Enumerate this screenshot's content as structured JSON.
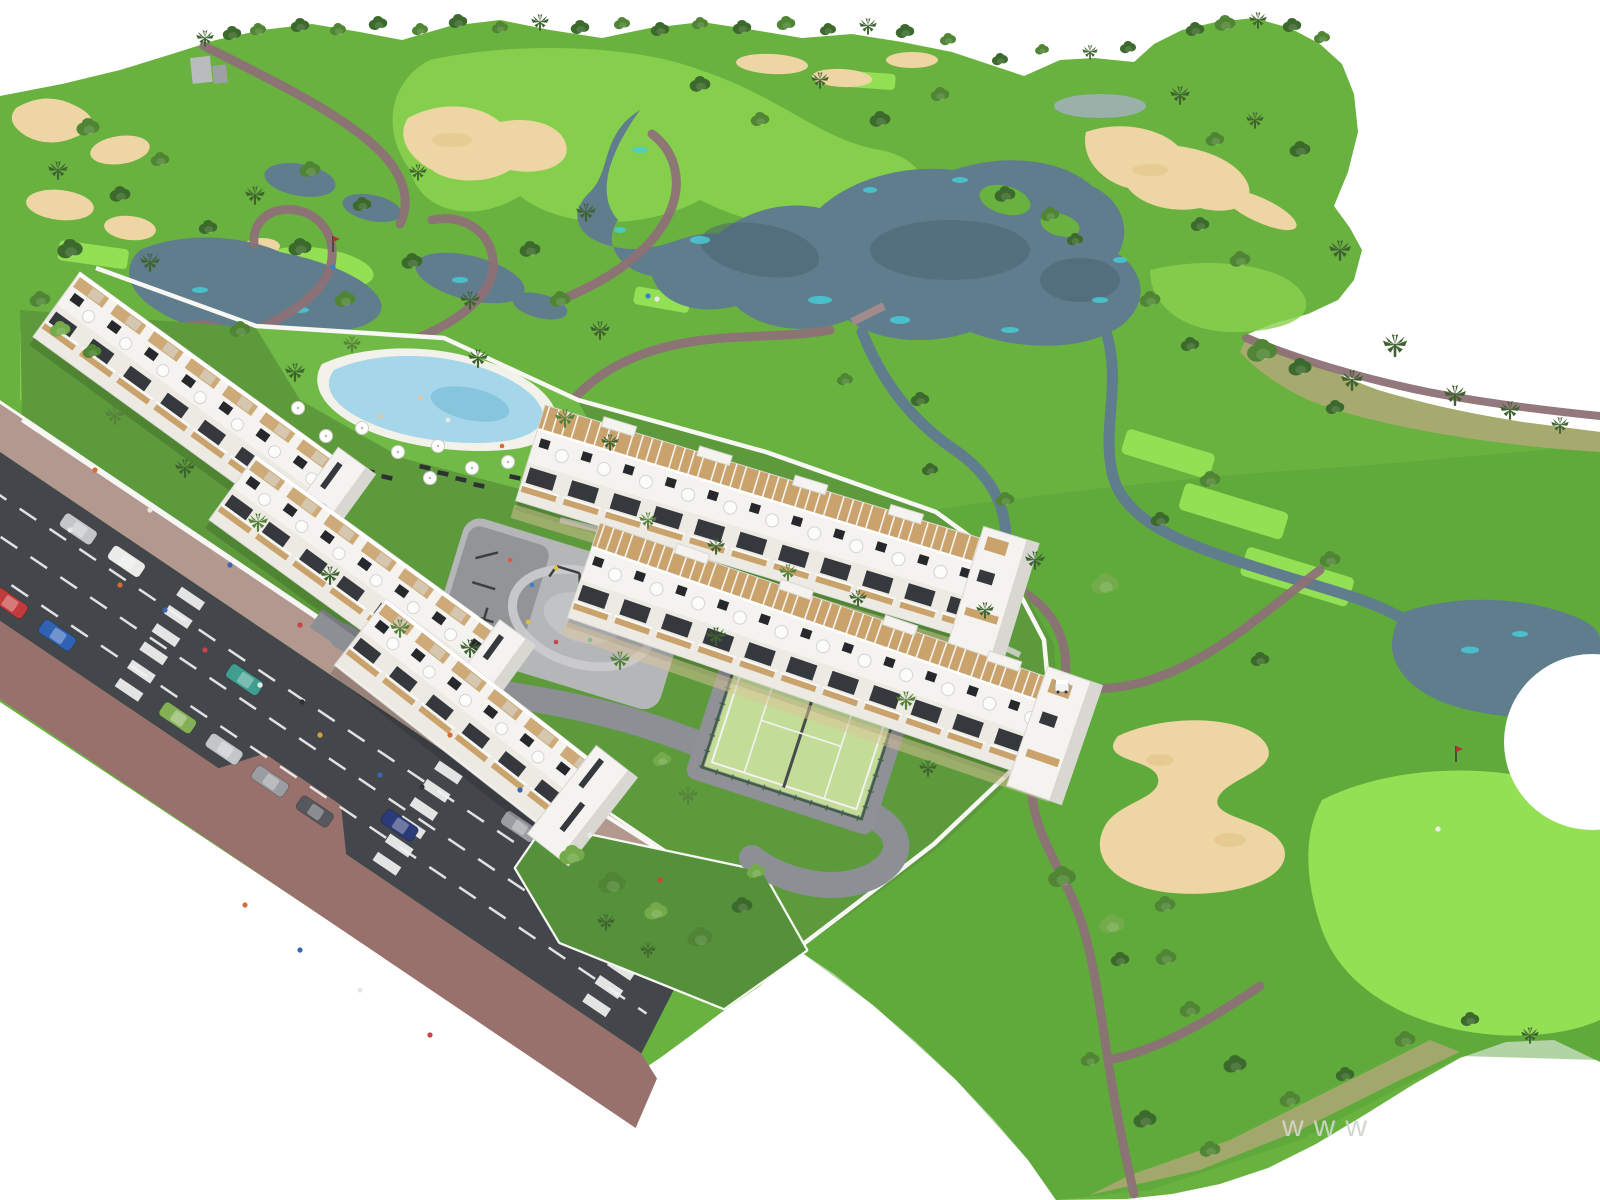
{
  "scene": {
    "type": "aerial-3d-architectural-render",
    "subject": "white apartment resort beside golf course with lakes, bunkers, pool, padel court and access road",
    "watermark": "www"
  },
  "palette": {
    "bg": "#ffffff",
    "grass": "#69b23f",
    "grass_light": "#8ad14f",
    "grass_bright": "#93e055",
    "grass_dark": "#55a038",
    "lawn": "#72ba47",
    "garden": "#5d9a3c",
    "garden_dark": "#55903a",
    "scrub": "#b3a878",
    "sand": "#edd6a3",
    "sand_dark": "#dfc083",
    "water": "#5f7d8d",
    "water_dark": "#49626f",
    "water_teal": "#45d0da",
    "pond_gray": "#9fb0b4",
    "pool": "#a5d6e9",
    "pool_deep": "#7fc0da",
    "path": "#8d7176",
    "path_light": "#a18a8c",
    "road": "#43474c",
    "sidewalk": "#99716c",
    "sidewalk_light": "#b3988f",
    "line_white": "#f2f2f2",
    "wall": "#f7f7f4",
    "bldg": "#f4f3ef",
    "bldg_shadow": "#d8d7d2",
    "facade": "#eceae3",
    "window": "#35383c",
    "wood": "#c9a26c",
    "plaza": "#b5b6b8",
    "plaza_dark": "#8c8e92",
    "court": "#c3dc97",
    "fence": "#415f48",
    "tree_dark": "#3c6a2c",
    "tree_mid": "#4f8534",
    "tree_light": "#74ab4a",
    "palm": "#3f6330",
    "palm_light": "#55823a",
    "watermark": "#cfd5cb"
  },
  "road": {
    "cars": [
      [
        108,
        20,
        "#c3c6c9"
      ],
      [
        166,
        20,
        "#ebebe9"
      ],
      [
        640,
        20,
        "#9a9da1"
      ],
      [
        700,
        21,
        "#55585c"
      ],
      [
        758,
        22,
        "#c3c6c9"
      ],
      [
        34,
        120,
        "#ebebe9"
      ],
      [
        92,
        120,
        "#c23a3a"
      ],
      [
        150,
        120,
        "#2f62b4"
      ],
      [
        296,
        121,
        "#83b054"
      ],
      [
        352,
        121,
        "#c3c6c9"
      ],
      [
        408,
        122,
        "#9a9da1"
      ],
      [
        462,
        122,
        "#55585c"
      ],
      [
        540,
        86,
        "#2b3a78"
      ],
      [
        330,
        52,
        "#3f9e8f"
      ],
      [
        845,
        60,
        "#55585c"
      ]
    ]
  },
  "people": [
    [
      70,
      530,
      "#e8e8e8"
    ],
    [
      120,
      585,
      "#d96a35"
    ],
    [
      165,
      610,
      "#3a66b0"
    ],
    [
      205,
      650,
      "#c94444"
    ],
    [
      260,
      685,
      "#e8e8e8"
    ],
    [
      320,
      735,
      "#d9a13a"
    ],
    [
      380,
      775,
      "#3a66b0"
    ],
    [
      95,
      470,
      "#d96a35"
    ],
    [
      150,
      510,
      "#e8e8e8"
    ],
    [
      230,
      565,
      "#3a66b0"
    ],
    [
      300,
      625,
      "#c94444"
    ],
    [
      375,
      680,
      "#e8e8e8"
    ],
    [
      450,
      735,
      "#d96a35"
    ],
    [
      520,
      790,
      "#3a66b0"
    ],
    [
      590,
      835,
      "#e8e8e8"
    ],
    [
      660,
      880,
      "#c94444"
    ],
    [
      245,
      905,
      "#d96a35"
    ],
    [
      300,
      950,
      "#3a66b0"
    ],
    [
      360,
      990,
      "#e8e8e8"
    ],
    [
      430,
      1035,
      "#c94444"
    ],
    [
      302,
      702,
      "#2f3234"
    ],
    [
      422,
      787,
      "#2f3234"
    ]
  ],
  "pool": {
    "umbrellas": [
      [
        298,
        408
      ],
      [
        326,
        436
      ],
      [
        362,
        428
      ],
      [
        398,
        452
      ],
      [
        438,
        446
      ],
      [
        472,
        468
      ],
      [
        508,
        462
      ],
      [
        546,
        452
      ],
      [
        584,
        444
      ],
      [
        350,
        468
      ],
      [
        312,
        452
      ],
      [
        430,
        478
      ],
      [
        282,
        430
      ],
      [
        596,
        462
      ]
    ],
    "swimmers": [
      [
        380,
        416,
        "#e8c49e"
      ],
      [
        448,
        420,
        "#e8e8e8"
      ],
      [
        502,
        446,
        "#d96a35"
      ],
      [
        420,
        398,
        "#e8c49e"
      ]
    ]
  },
  "playground": {
    "people": [
      [
        510,
        560,
        "#d95f3b"
      ],
      [
        532,
        585,
        "#3a7fd0"
      ],
      [
        556,
        568,
        "#e0c23a"
      ],
      [
        576,
        600,
        "#c94444"
      ],
      [
        598,
        586,
        "#3fae9e"
      ],
      [
        618,
        612,
        "#e8e8e8"
      ],
      [
        640,
        600,
        "#d95f3b"
      ],
      [
        662,
        626,
        "#3a7fd0"
      ],
      [
        528,
        622,
        "#e0c23a"
      ],
      [
        556,
        642,
        "#c94444"
      ],
      [
        590,
        640,
        "#3fae9e"
      ],
      [
        622,
        560,
        "#e8e8e8"
      ]
    ]
  },
  "golf": {
    "figures": [
      [
        648,
        296,
        "#3a7fd0"
      ],
      [
        657,
        299,
        "#e8e8e8"
      ],
      [
        333,
        267,
        "#3a7fd0"
      ],
      [
        1438,
        829,
        "#ececec"
      ]
    ],
    "flags": [
      [
        333,
        252
      ],
      [
        1456,
        762
      ]
    ],
    "cart": [
      1062,
      688
    ]
  },
  "vegetation": [
    [
      205,
      38,
      "p",
      0.8,
      "palm"
    ],
    [
      232,
      34,
      "d",
      0.8,
      "tree_dark"
    ],
    [
      258,
      30,
      "d",
      0.7,
      "tree_mid"
    ],
    [
      300,
      26,
      "d",
      0.8,
      "tree_dark"
    ],
    [
      338,
      30,
      "d",
      0.7,
      "tree_mid"
    ],
    [
      378,
      24,
      "d",
      0.8,
      "tree_dark"
    ],
    [
      420,
      30,
      "d",
      0.7,
      "tree_mid"
    ],
    [
      458,
      22,
      "d",
      0.8,
      "tree_dark"
    ],
    [
      500,
      28,
      "d",
      0.7,
      "tree_mid"
    ],
    [
      540,
      22,
      "p",
      0.8,
      "palm"
    ],
    [
      580,
      28,
      "d",
      0.8,
      "tree_dark"
    ],
    [
      622,
      24,
      "d",
      0.7,
      "tree_mid"
    ],
    [
      660,
      30,
      "d",
      0.8,
      "tree_dark"
    ],
    [
      700,
      24,
      "d",
      0.7,
      "tree_mid"
    ],
    [
      742,
      28,
      "d",
      0.8,
      "tree_dark"
    ],
    [
      786,
      24,
      "d",
      0.8,
      "tree_mid"
    ],
    [
      828,
      30,
      "d",
      0.7,
      "tree_dark"
    ],
    [
      868,
      26,
      "p",
      0.8,
      "palm"
    ],
    [
      905,
      32,
      "d",
      0.8,
      "tree_dark"
    ],
    [
      948,
      40,
      "d",
      0.7,
      "tree_mid"
    ],
    [
      1000,
      60,
      "d",
      0.7,
      "tree_dark"
    ],
    [
      1042,
      50,
      "d",
      0.6,
      "tree_mid"
    ],
    [
      1090,
      52,
      "p",
      0.7,
      "palm"
    ],
    [
      1128,
      48,
      "d",
      0.7,
      "tree_dark"
    ],
    [
      1195,
      30,
      "d",
      0.8,
      "tree_dark"
    ],
    [
      1225,
      24,
      "d",
      0.9,
      "tree_mid"
    ],
    [
      1258,
      20,
      "p",
      0.8,
      "palm"
    ],
    [
      1292,
      26,
      "d",
      0.8,
      "tree_dark"
    ],
    [
      1322,
      38,
      "d",
      0.7,
      "tree_mid"
    ],
    [
      88,
      128,
      "d",
      1,
      "tree_mid"
    ],
    [
      58,
      170,
      "p",
      0.9,
      "palm"
    ],
    [
      120,
      195,
      "d",
      0.9,
      "tree_dark"
    ],
    [
      160,
      160,
      "d",
      0.8,
      "tree_mid"
    ],
    [
      70,
      250,
      "d",
      1.1,
      "tree_dark"
    ],
    [
      150,
      262,
      "p",
      0.9,
      "palm"
    ],
    [
      40,
      300,
      "d",
      0.9,
      "tree_mid"
    ],
    [
      208,
      228,
      "d",
      0.8,
      "tree_dark"
    ],
    [
      255,
      195,
      "p",
      0.9,
      "palm"
    ],
    [
      310,
      170,
      "d",
      0.9,
      "tree_mid"
    ],
    [
      362,
      205,
      "d",
      0.8,
      "tree_dark"
    ],
    [
      418,
      172,
      "p",
      0.8,
      "palm"
    ],
    [
      300,
      248,
      "d",
      1,
      "tree_dark"
    ],
    [
      345,
      300,
      "d",
      0.9,
      "tree_mid"
    ],
    [
      412,
      262,
      "d",
      0.9,
      "tree_dark"
    ],
    [
      470,
      300,
      "p",
      0.9,
      "palm"
    ],
    [
      240,
      330,
      "d",
      0.9,
      "tree_mid"
    ],
    [
      60,
      330,
      "d",
      0.9,
      "tree_light"
    ],
    [
      92,
      352,
      "d",
      0.8,
      "tree_mid"
    ],
    [
      530,
      250,
      "d",
      0.9,
      "tree_dark"
    ],
    [
      586,
      212,
      "p",
      0.9,
      "palm"
    ],
    [
      560,
      300,
      "d",
      0.9,
      "tree_mid"
    ],
    [
      600,
      330,
      "p",
      0.9,
      "palm"
    ],
    [
      700,
      85,
      "d",
      0.9,
      "tree_dark"
    ],
    [
      760,
      120,
      "d",
      0.8,
      "tree_mid"
    ],
    [
      820,
      80,
      "p",
      0.8,
      "palm"
    ],
    [
      880,
      120,
      "d",
      0.9,
      "tree_dark"
    ],
    [
      940,
      95,
      "d",
      0.8,
      "tree_mid"
    ],
    [
      1005,
      195,
      "d",
      0.9,
      "tree_dark"
    ],
    [
      1050,
      215,
      "d",
      0.8,
      "tree_mid"
    ],
    [
      1075,
      240,
      "d",
      0.7,
      "tree_dark"
    ],
    [
      1150,
      300,
      "d",
      0.9,
      "tree_mid"
    ],
    [
      1190,
      345,
      "d",
      0.8,
      "tree_dark"
    ],
    [
      845,
      380,
      "d",
      0.7,
      "tree_mid"
    ],
    [
      920,
      400,
      "d",
      0.8,
      "tree_dark"
    ],
    [
      1180,
      95,
      "p",
      0.9,
      "palm"
    ],
    [
      1215,
      140,
      "d",
      0.8,
      "tree_mid"
    ],
    [
      1255,
      120,
      "p",
      0.8,
      "palm"
    ],
    [
      1300,
      150,
      "d",
      0.9,
      "tree_dark"
    ],
    [
      1340,
      250,
      "p",
      1,
      "palm"
    ],
    [
      1240,
      260,
      "d",
      0.9,
      "tree_mid"
    ],
    [
      1200,
      225,
      "d",
      0.8,
      "tree_dark"
    ],
    [
      1262,
      352,
      "d",
      1.3,
      "tree_mid"
    ],
    [
      1300,
      368,
      "d",
      1,
      "tree_dark"
    ],
    [
      1352,
      380,
      "p",
      1,
      "palm"
    ],
    [
      1395,
      345,
      "p",
      1.1,
      "palm"
    ],
    [
      1455,
      395,
      "p",
      1,
      "palm"
    ],
    [
      1510,
      410,
      "p",
      0.9,
      "palm"
    ],
    [
      1560,
      425,
      "p",
      0.8,
      "palm"
    ],
    [
      1335,
      408,
      "d",
      0.8,
      "tree_dark"
    ],
    [
      1210,
      480,
      "d",
      0.9,
      "tree_mid"
    ],
    [
      1160,
      520,
      "d",
      0.8,
      "tree_dark"
    ],
    [
      1330,
      560,
      "d",
      0.9,
      "tree_mid"
    ],
    [
      1260,
      660,
      "d",
      0.8,
      "tree_dark"
    ],
    [
      1035,
      560,
      "p",
      0.9,
      "palm"
    ],
    [
      985,
      610,
      "p",
      0.8,
      "palm"
    ],
    [
      1105,
      585,
      "d",
      1.2,
      "tree_light"
    ],
    [
      1165,
      905,
      "d",
      0.9,
      "tree_mid"
    ],
    [
      1120,
      960,
      "d",
      0.8,
      "tree_dark"
    ],
    [
      1190,
      1010,
      "d",
      0.9,
      "tree_mid"
    ],
    [
      1235,
      1065,
      "d",
      1,
      "tree_dark"
    ],
    [
      1290,
      1100,
      "d",
      0.9,
      "tree_mid"
    ],
    [
      1345,
      1075,
      "d",
      0.8,
      "tree_dark"
    ],
    [
      1405,
      1040,
      "d",
      0.9,
      "tree_mid"
    ],
    [
      1470,
      1020,
      "d",
      0.8,
      "tree_dark"
    ],
    [
      1530,
      1035,
      "p",
      0.8,
      "palm"
    ],
    [
      1090,
      1060,
      "d",
      0.8,
      "tree_mid"
    ],
    [
      1145,
      1120,
      "d",
      1,
      "tree_dark"
    ],
    [
      1210,
      1150,
      "d",
      0.9,
      "tree_mid"
    ],
    [
      115,
      415,
      "p",
      0.9,
      "palm_light"
    ],
    [
      185,
      468,
      "p",
      0.9,
      "palm"
    ],
    [
      258,
      522,
      "p",
      0.9,
      "palm_light"
    ],
    [
      330,
      575,
      "p",
      0.9,
      "palm"
    ],
    [
      400,
      628,
      "p",
      0.9,
      "palm_light"
    ],
    [
      470,
      648,
      "p",
      0.9,
      "palm"
    ],
    [
      620,
      660,
      "p",
      0.9,
      "palm_light"
    ],
    [
      295,
      372,
      "p",
      0.9,
      "palm"
    ],
    [
      352,
      344,
      "p",
      0.8,
      "palm_light"
    ],
    [
      478,
      358,
      "p",
      0.9,
      "palm"
    ],
    [
      565,
      418,
      "p",
      0.9,
      "palm_light"
    ],
    [
      610,
      442,
      "p",
      0.8,
      "palm"
    ],
    [
      648,
      520,
      "p",
      0.8,
      "palm_light"
    ],
    [
      716,
      546,
      "p",
      0.8,
      "palm"
    ],
    [
      788,
      572,
      "p",
      0.8,
      "palm_light"
    ],
    [
      858,
      598,
      "p",
      0.8,
      "palm"
    ],
    [
      716,
      636,
      "p",
      0.9,
      "palm"
    ],
    [
      906,
      700,
      "p",
      0.9,
      "palm_light"
    ],
    [
      928,
      768,
      "p",
      0.8,
      "palm"
    ],
    [
      688,
      795,
      "p",
      0.9,
      "palm_light"
    ],
    [
      662,
      760,
      "d",
      0.8,
      "tree_light"
    ],
    [
      572,
      856,
      "d",
      1.1,
      "tree_light"
    ],
    [
      612,
      884,
      "d",
      1.2,
      "tree_mid"
    ],
    [
      656,
      912,
      "d",
      1,
      "tree_light"
    ],
    [
      700,
      938,
      "d",
      1.1,
      "tree_mid"
    ],
    [
      742,
      906,
      "d",
      0.9,
      "tree_dark"
    ],
    [
      756,
      872,
      "d",
      0.8,
      "tree_light"
    ],
    [
      606,
      922,
      "p",
      0.8,
      "palm"
    ],
    [
      648,
      950,
      "p",
      0.7,
      "palm"
    ],
    [
      1062,
      878,
      "d",
      1.2,
      "tree_mid"
    ],
    [
      1112,
      925,
      "d",
      1.1,
      "tree_light"
    ],
    [
      1166,
      958,
      "d",
      0.9,
      "tree_mid"
    ],
    [
      1005,
      500,
      "d",
      0.8,
      "tree_mid"
    ],
    [
      930,
      470,
      "d",
      0.7,
      "tree_dark"
    ]
  ]
}
